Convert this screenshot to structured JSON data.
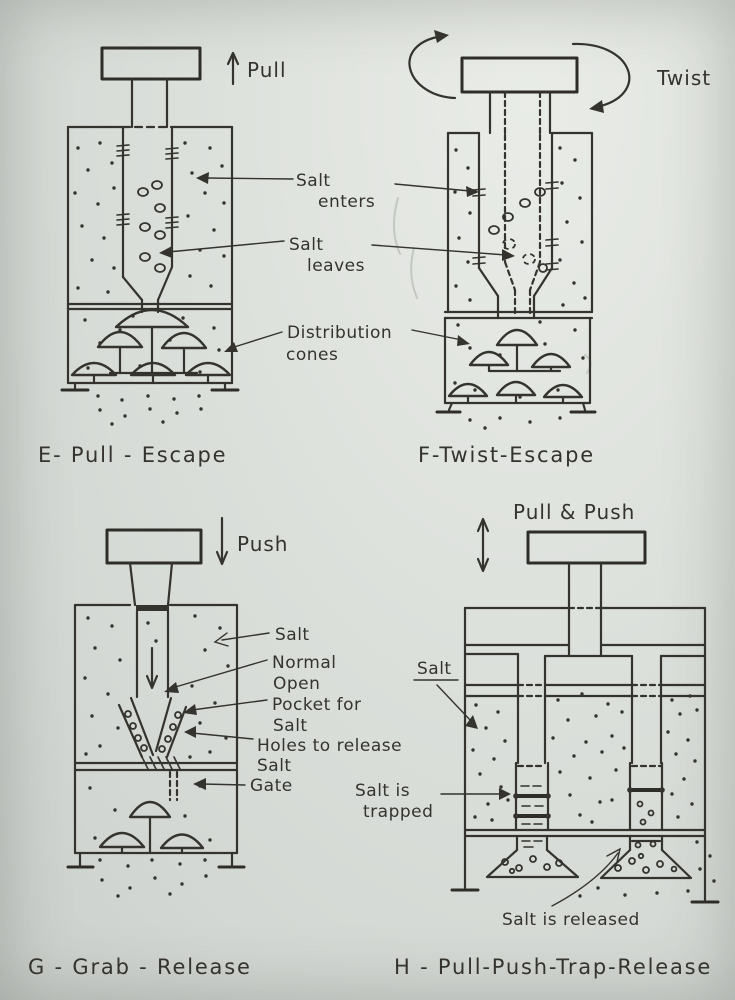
{
  "colors": {
    "paper": "#dde1dc",
    "ink": "#34332d"
  },
  "diagram_e": {
    "action": "Pull",
    "caption": "E- Pull - Escape"
  },
  "diagram_f": {
    "action": "Twist",
    "caption": "F-Twist-Escape"
  },
  "diagram_g": {
    "action": "Push",
    "caption": "G - Grab - Release",
    "label_salt": "Salt",
    "label_normal_1": "Normal",
    "label_normal_2": "Open",
    "label_pocket_1": "Pocket for",
    "label_pocket_2": "Salt",
    "label_holes_1": "Holes to release",
    "label_holes_2": "Salt",
    "label_gate": "Gate"
  },
  "diagram_h": {
    "action": "Pull & Push",
    "caption": "H - Pull-Push-Trap-Release",
    "label_salt": "Salt",
    "label_trapped_1": "Salt is",
    "label_trapped_2": "trapped",
    "label_released": "Salt is released"
  },
  "annotations": {
    "salt_enters_1": "Salt",
    "salt_enters_2": "enters",
    "salt_leaves_1": "Salt",
    "salt_leaves_2": "leaves",
    "cones_1": "Distribution",
    "cones_2": "cones"
  }
}
